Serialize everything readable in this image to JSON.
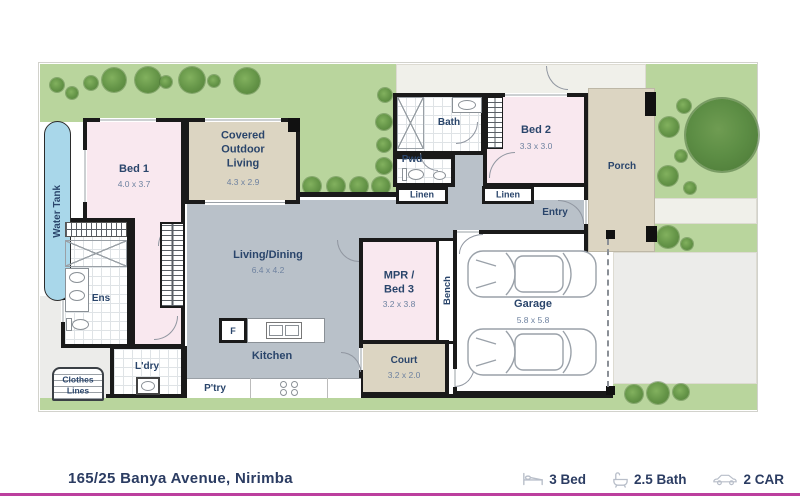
{
  "plan": {
    "rooms": {
      "bed1": {
        "name": "Bed 1",
        "dims": "4.0 x 3.7"
      },
      "covered_outdoor_living": {
        "name": "Covered Outdoor Living",
        "dims": "4.3 x 2.9"
      },
      "living_dining": {
        "name": "Living/Dining",
        "dims": "6.4 x 4.2"
      },
      "kitchen": {
        "name": "Kitchen"
      },
      "pantry": {
        "name": "P'try"
      },
      "laundry": {
        "name": "L'dry"
      },
      "ensuite": {
        "name": "Ens"
      },
      "bath": {
        "name": "Bath"
      },
      "powder": {
        "name": "Pwd"
      },
      "linen_left": {
        "name": "Linen"
      },
      "linen_right": {
        "name": "Linen"
      },
      "bed2": {
        "name": "Bed 2",
        "dims": "3.3 x 3.0"
      },
      "mpr_bed3": {
        "name": "MPR / Bed 3",
        "dims": "3.2 x 3.8"
      },
      "bench": {
        "name": "Bench"
      },
      "garage": {
        "name": "Garage",
        "dims": "5.8 x 5.8"
      },
      "court": {
        "name": "Court",
        "dims": "3.2 x 2.0"
      },
      "entry": {
        "name": "Entry"
      },
      "porch": {
        "name": "Porch"
      }
    },
    "fixtures": {
      "water_tank": "Water Tank",
      "clothes_lines": "Clothes Lines",
      "fridge": "F"
    }
  },
  "footer": {
    "address": "165/25 Banya Avenue, Nirimba",
    "stats": [
      {
        "icon": "bed-icon",
        "label": "3 Bed"
      },
      {
        "icon": "bath-icon",
        "label": "2.5 Bath"
      },
      {
        "icon": "car-icon",
        "label": "2 CAR"
      }
    ]
  },
  "colors": {
    "lawn": "#b9d59d",
    "room_pink": "#f9e8ef",
    "room_beige": "#dcd5c2",
    "floor_gray": "#b9c1c9",
    "water_tank_blue": "#a9d7ea",
    "label_navy": "#2a456b",
    "accent_magenta": "#bc3f9e"
  }
}
